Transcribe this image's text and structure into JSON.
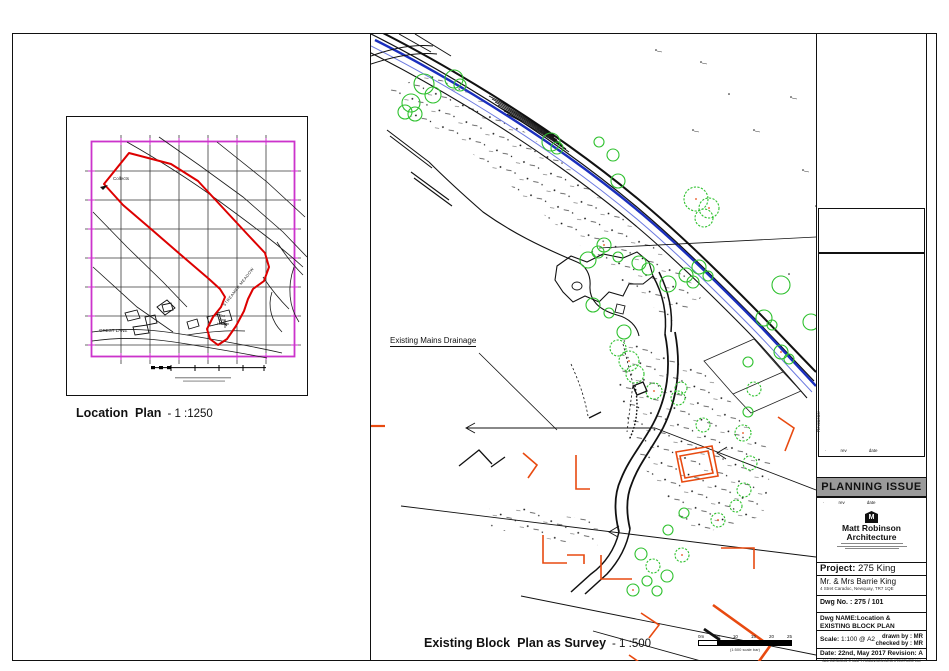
{
  "colors": {
    "boundary_red": "#dd0000",
    "map_border_magenta": "#cc33cc",
    "tree_green": "#2ec12e",
    "water_blue": "#1b2fbe",
    "building_orange": "#e84a10",
    "banner_gray": "#9a9a9a"
  },
  "location_plan": {
    "caption": "Location  Plan",
    "caption_scale": "- 1 :1250",
    "labels": {
      "collects": "Collects",
      "lane": "GREST LANE",
      "house_l1": "The",
      "house_l2": "King",
      "house_l3": "House",
      "meadow": "STREAMER MEADOW"
    }
  },
  "main_plan": {
    "drainage_label": "Existing Mains Drainage",
    "caption": "Existing Block  Plan as Survey",
    "caption_scale": "- 1 :500",
    "scalebar": {
      "ticks": [
        "0m",
        "5",
        "10",
        "15",
        "20",
        "25"
      ],
      "note": "(1:500 scale bar)"
    }
  },
  "titleblock": {
    "revisions_label": "Revisions:",
    "rev_header": {
      "bullet": "·",
      "rev": "rev",
      "date": "date"
    },
    "banner": "PLANNING ISSUE",
    "logo": {
      "initial": "M",
      "name_line1": "Matt Robinson",
      "name_line2": "Architecture"
    },
    "project": {
      "label": "Project:",
      "value": "275 King"
    },
    "client": {
      "name": "Mr. & Mrs Barrie King",
      "address": "4 Stret Caradoc, Newquay, TR7 1QE"
    },
    "dwg_no": {
      "label": "Dwg No. :",
      "value": "275 / 101"
    },
    "dwg_name": {
      "line1": "Dwg NAME:Location &",
      "line2": "EXISTING BLOCK PLAN"
    },
    "scale": {
      "label": "Scale:",
      "value": "1:100 @ A2"
    },
    "drawn_by": {
      "label": "drawn by :",
      "value": "MR"
    },
    "checked_by": {
      "label": "checked by :",
      "value": "MR"
    },
    "date": {
      "label": "Date:",
      "value": "22nd, May 2017"
    },
    "revision": {
      "label": "Revision:",
      "value": "A"
    },
    "copyright": "ALL DESIGNS © MATT ROBINSON ARCHITECTURE Ltd"
  }
}
